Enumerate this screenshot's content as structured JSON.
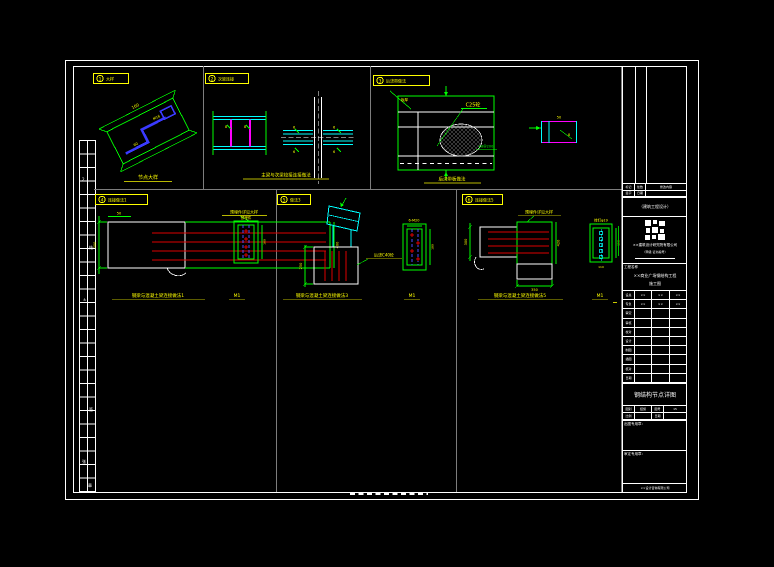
{
  "palette": {
    "background": "#000000",
    "frame_white": "#ffffff",
    "divider_gray": "#7d7d7d",
    "dimension_green": "#00ff00",
    "steel_cyan": "#00ffff",
    "stiffener_magenta": "#ff00ff",
    "rebar_red": "#dd0000",
    "plate_blue": "#3a3aff",
    "annotation_yellow": "#ffff00"
  },
  "callouts": [
    {
      "num": "1",
      "label": "大样"
    },
    {
      "num": "2",
      "label": "次梁连接"
    },
    {
      "num": "3",
      "label": "后浇带做法"
    },
    {
      "num": "4",
      "label": "连接做法1"
    },
    {
      "num": "5",
      "label": "做法3"
    },
    {
      "num": "6",
      "label": "连接做法5"
    }
  ],
  "details": {
    "d1": {
      "title": "节点大样",
      "dim_a": "160",
      "dim_b": "60",
      "note": "M16"
    },
    "d2": {
      "title": "主梁与次梁铰接连接做法",
      "tick1": "8",
      "tick2": "8",
      "q1": "6",
      "q2": "6",
      "q3": "6",
      "q4": "6"
    },
    "d3": {
      "title": "后浇带板做法",
      "note_plate": "板厚",
      "note_conc": "C25砼",
      "note_rebar": "φ8@200",
      "sub_dim": "50",
      "sub_tag": "8"
    },
    "d4": {
      "title": "钢梁与混凝土梁连接做法1",
      "scale": "M1",
      "note": "预埋件详见大样",
      "dim_left": "300",
      "dim_top": "50",
      "dim_right": "400",
      "bolt_tag": "预埋件",
      "bolt_dim": "160"
    },
    "d5": {
      "title": "钢梁与混凝土梁连接做法3",
      "scale": "M1",
      "note": "后浇C40砼",
      "dim_left": "250",
      "bolt_tag": "6-M20",
      "bolt_dim": "180"
    },
    "d6": {
      "title": "钢梁与混凝土梁连接做法5",
      "scale": "M1",
      "note": "预埋件详见大样",
      "dim_left": "300",
      "dim_bottom": "350",
      "dim_right": "420",
      "bolt_tag": "栓钉φ19",
      "bolt_dim": "150",
      "bolt_sub": "110"
    }
  },
  "titleblock": {
    "rev": {
      "c1": "标记",
      "c2": "处数",
      "c3": "修改内容",
      "r2c1": "签字",
      "r2c2": "日期",
      "r2c3": ""
    },
    "org_note": "（建筑工程设计）",
    "company": "××建筑设计研究院有限公司",
    "cert": "（甲级·证书编号）",
    "project_label": "工程名称",
    "project_line1": "××商业广场钢结构工程",
    "project_line2": "施工图",
    "sig_rows": [
      {
        "label": "设总",
        "v1": "××",
        "v2": "××",
        "v3": "××"
      },
      {
        "label": "专负",
        "v1": "××",
        "v2": "××",
        "v3": "××"
      },
      {
        "label": "审定"
      },
      {
        "label": "审核"
      },
      {
        "label": "校对"
      },
      {
        "label": "设计"
      },
      {
        "label": "制图"
      },
      {
        "label": "描图"
      },
      {
        "label": "核对"
      },
      {
        "label": "日期"
      }
    ],
    "drawing_title": "钢结构节点详图",
    "info_r1": {
      "l1": "图别",
      "v1": "结施",
      "l2": "图号",
      "v2": "15"
    },
    "info_r2": {
      "l1": "比例",
      "v1": "",
      "l2": "日期",
      "v2": ""
    },
    "seal1": "出图专用章：",
    "seal2": "审定专用章：",
    "footer": "××设计咨询有限公司"
  },
  "strip_cells": {
    "t1": "2",
    "t2": "结",
    "t3": "±",
    "t4": "签",
    "t5": "张",
    "t6": "章"
  }
}
